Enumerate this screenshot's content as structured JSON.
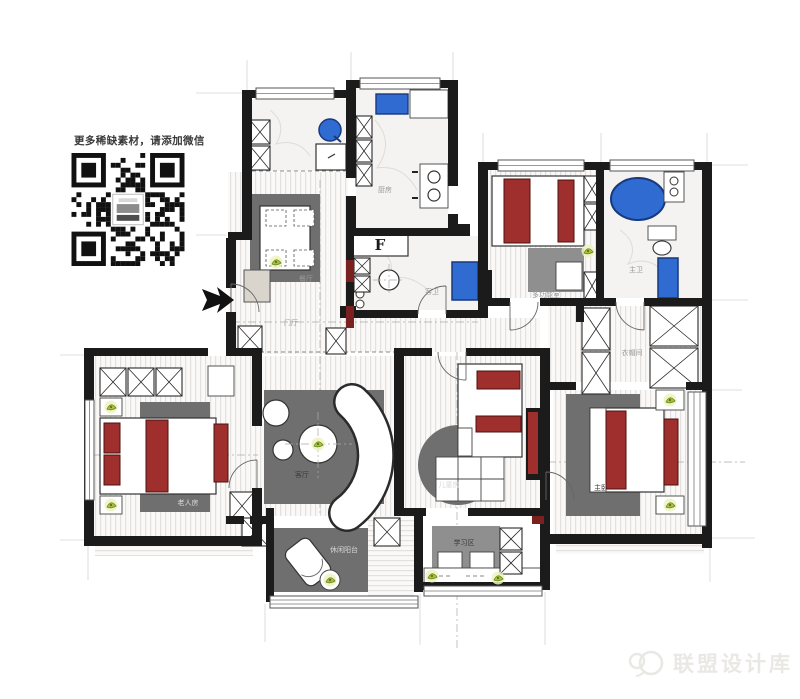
{
  "promo": {
    "text": "更多稀缺素材，请添加微信"
  },
  "watermark": {
    "text": "联盟设计库"
  },
  "rooms": {
    "kitchen": "厨房",
    "guest_bath": "客卫",
    "dining": "餐厅",
    "foyer": "门厅",
    "living": "客厅",
    "multi_function": "多功能室",
    "master_bath": "主卫",
    "closet": "衣帽间",
    "master_bedroom": "主卧",
    "kids_room": "儿童房",
    "study": "学习区",
    "balcony": "休闲阳台",
    "elder_room": "老人房"
  },
  "symbols": {
    "fridge": "F"
  },
  "colors": {
    "wall": "#1b1b1b",
    "accent_red": "#9e2f2c",
    "maroon": "#7a2120",
    "fixture_blue": "#2f6bd0",
    "fixture_blue_dark": "#17397e",
    "rug_gray": "#6f6f6f",
    "desk_gray": "#8f8f8f",
    "label_gray": "#9a9a9a",
    "plant_green": "#a9c23f",
    "watermark_gray": "#eae8e4"
  }
}
